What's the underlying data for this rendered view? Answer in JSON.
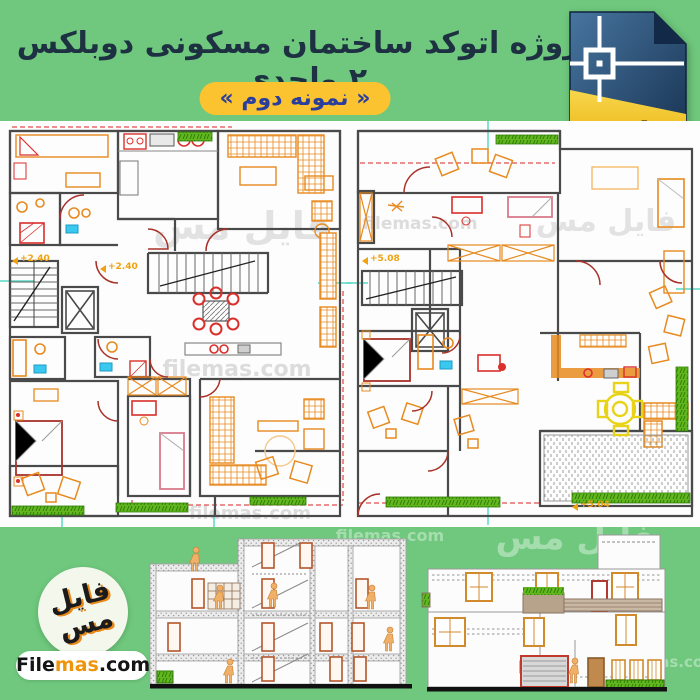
{
  "header": {
    "title": "پروژه اتوکد ساختمان مسکونی دوبلکس ۲ واحدی",
    "badge": "« نمونه دوم »"
  },
  "file_icon": {
    "label": ".dwg"
  },
  "plans": {
    "left": {
      "marker_edge": "+2.40",
      "marker_center": "+2.40"
    },
    "right": {
      "marker_top": "+5.08",
      "marker_bottom": "+5.04"
    }
  },
  "watermarks": {
    "persian": "فایل مس",
    "latin": "filemas.com"
  },
  "logo": {
    "calligraphy": "فایل مس",
    "site_prefix": "File",
    "site_accent": "mas",
    "site_suffix": ".com"
  },
  "colors": {
    "background": "#6fc87d",
    "title_text": "#1d3142",
    "badge_bg": "#fcc330",
    "badge_text": "#2a3f9d",
    "wall": "#4a4a4a",
    "furniture": "#e78a1f",
    "door": "#a8322a",
    "fixture_red": "#d9302c",
    "accent_cyan": "#3bc8f0",
    "grass": "#55a31a",
    "marker_yellow": "#f0a20e",
    "dwg_navy": "#1f3f66",
    "dwg_gold": "#f2c013"
  }
}
